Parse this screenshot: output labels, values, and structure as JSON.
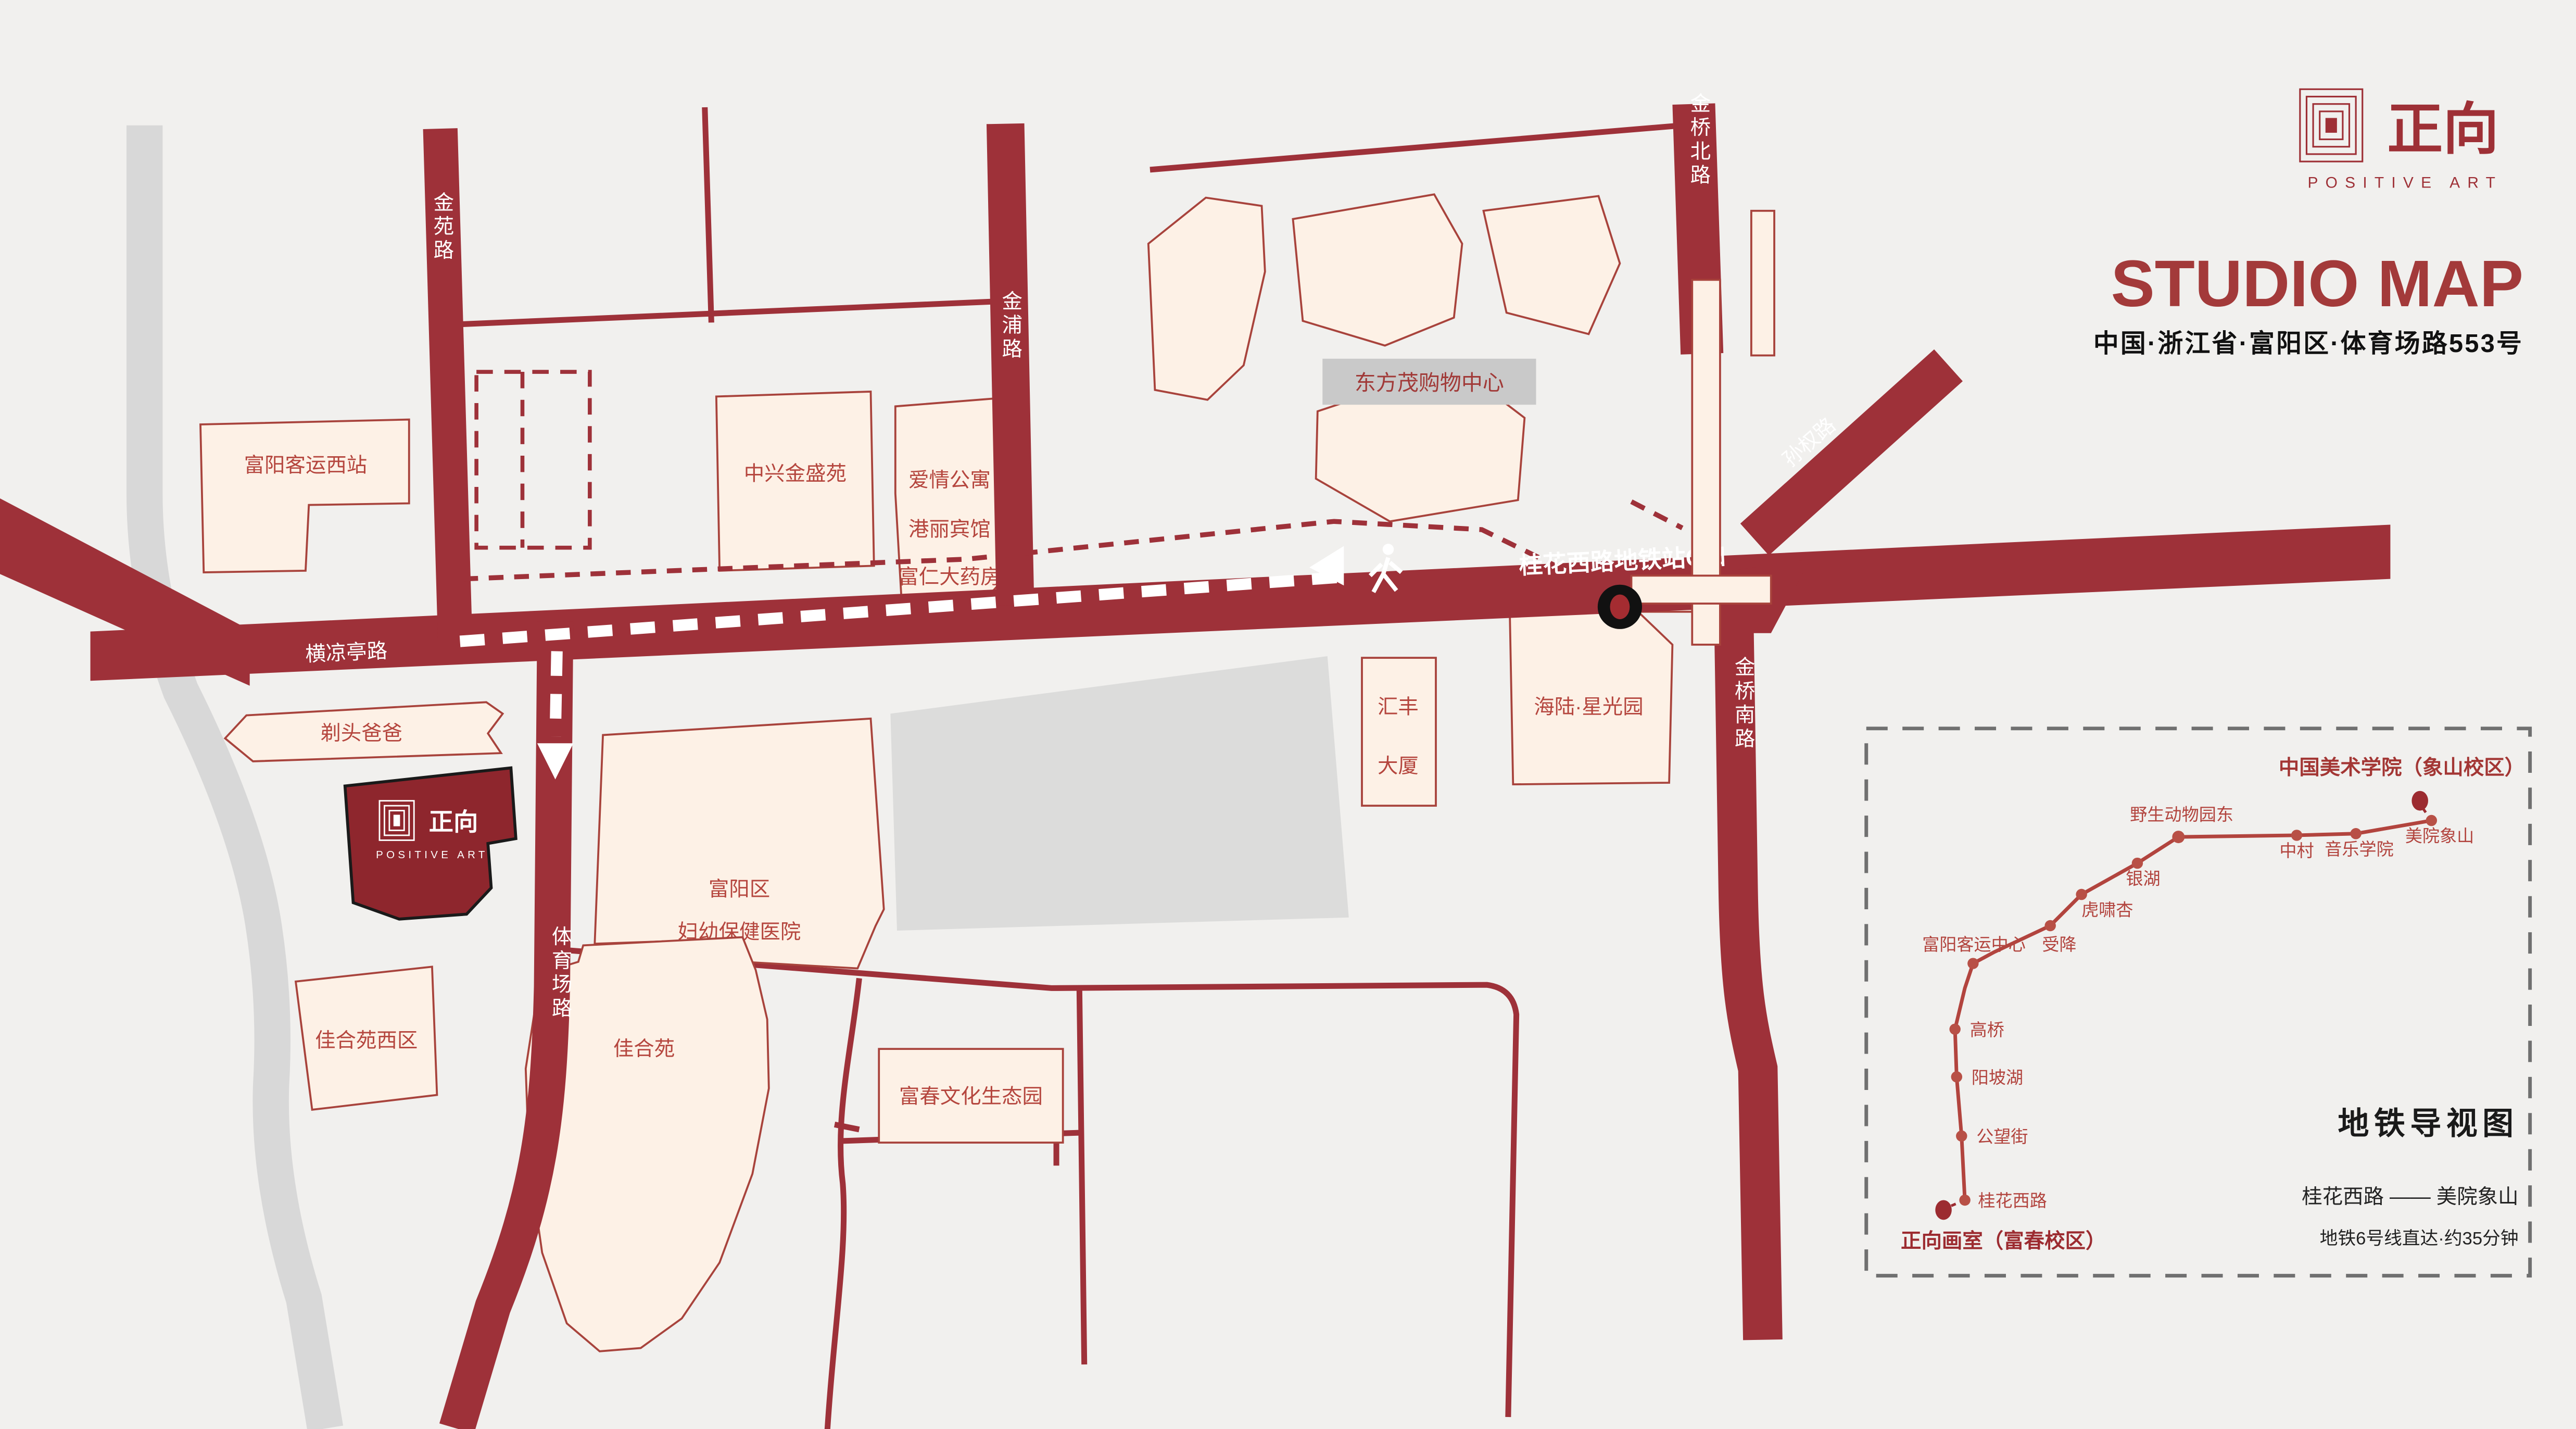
{
  "header": {
    "brand_zh": "正向",
    "brand_en": "POSITIVE ART",
    "title": "STUDIO MAP",
    "address": "中国·浙江省·富阳区·体育场路553号"
  },
  "map": {
    "roads": {
      "jinyuan": "金苑路",
      "jinpu": "金浦路",
      "jinqiao_north": "金桥北路",
      "sunquan": "孙权路",
      "jinqiao_south": "金桥南路",
      "hengliangting": "横凉亭路",
      "tiyuchang": "体育场路"
    },
    "metro_exit_label": "桂花西路地铁站C口",
    "buildings": {
      "west_bus_station": "富阳客运西站",
      "zhongxing": "中兴金盛苑",
      "apartment_line1": "爱情公寓",
      "apartment_line2": "港丽宾馆",
      "apartment_line3": "富仁大药房",
      "mall": "东方茂购物中心",
      "huifeng_line1": "汇丰",
      "huifeng_line2": "大厦",
      "hailu": "海陆·星光园",
      "hospital_line1": "富阳区",
      "hospital_line2": "妇幼保健医院",
      "barber": "剃头爸爸",
      "jiaheyuan_west": "佳合苑西区",
      "jiaheyuan": "佳合苑",
      "eco_park": "富春文化生态园"
    },
    "studio": {
      "zh": "正向",
      "en": "POSITIVE ART"
    }
  },
  "minimap": {
    "title": "地铁导视图",
    "origin": "正向画室（富春校区）",
    "destination": "中国美术学院（象山校区）",
    "route": "桂花西路 —— 美院象山",
    "note": "地铁6号线直达·约35分钟",
    "stations": [
      "桂花西路",
      "公望街",
      "阳坡湖",
      "高桥",
      "富阳客运中心",
      "受降",
      "虎啸杏",
      "银湖",
      "野生动物园东",
      "中村",
      "音乐学院",
      "美院象山"
    ]
  },
  "colors": {
    "road": "#9e3139",
    "building_fill": "#fdf1e6",
    "building_stroke": "#a8433c",
    "label_red": "#b5463e",
    "studio_fill": "#8e262d",
    "brand_red": "#9e3036",
    "metro_line": "#b2443e",
    "gray_road": "#d8d8d8",
    "gray_block": "#dcdcdb",
    "text_black": "#1a1a1a"
  }
}
